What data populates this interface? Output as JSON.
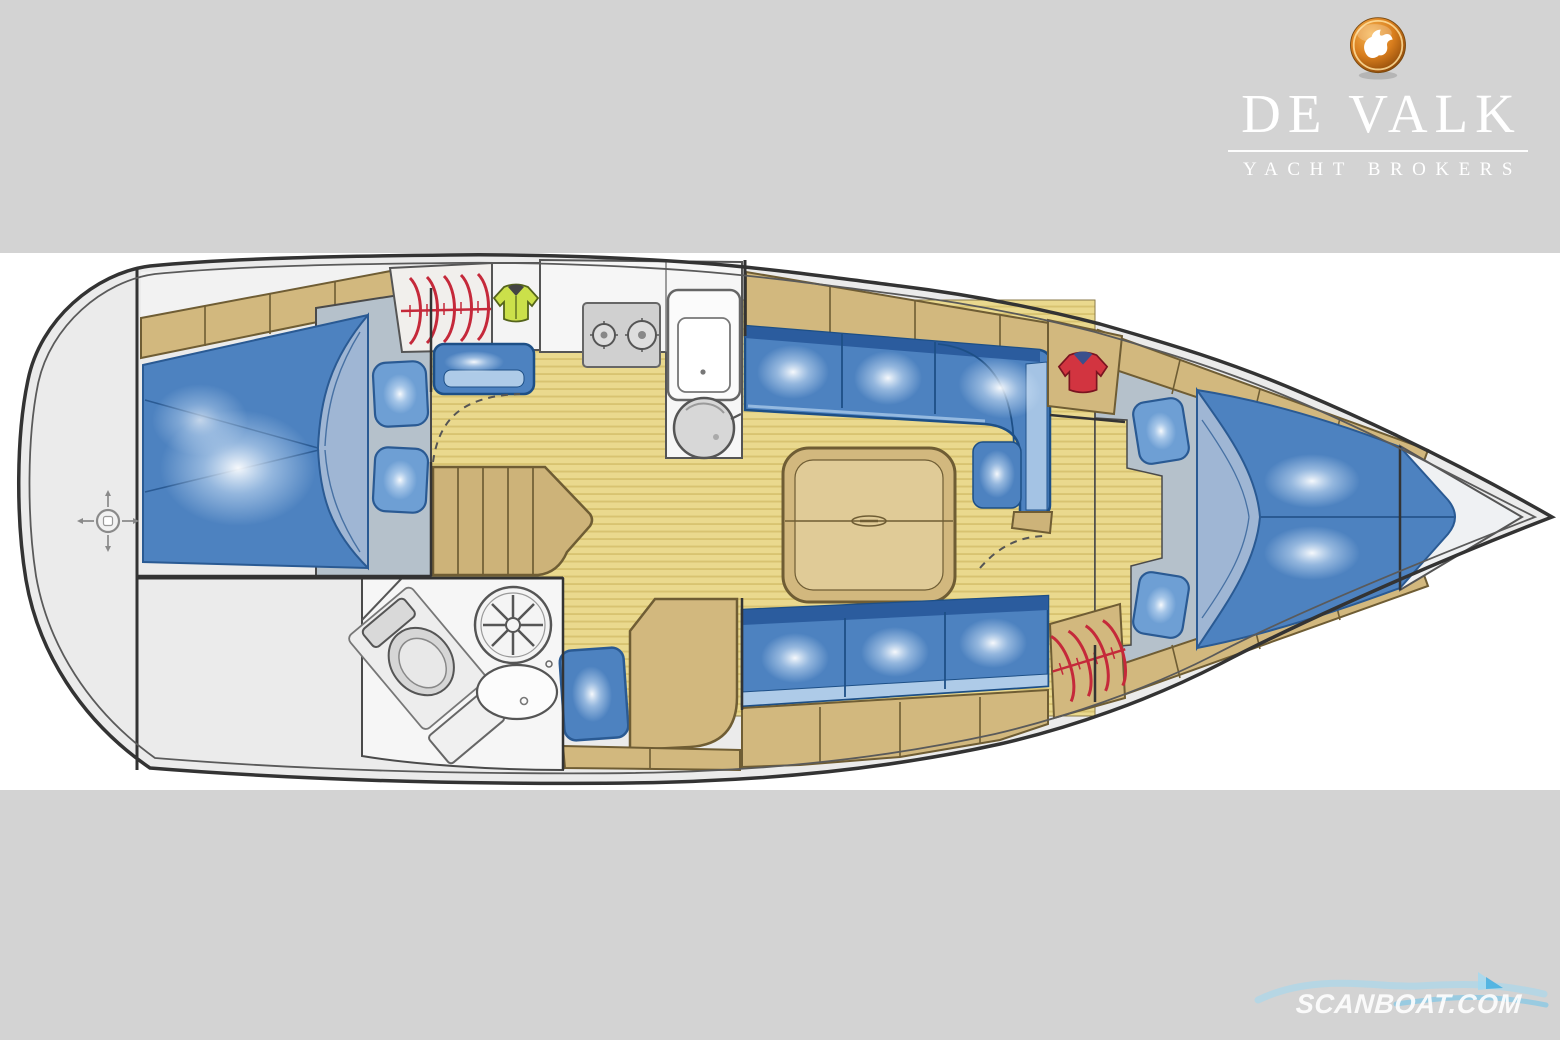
{
  "header": {
    "brand": "DE VALK",
    "tagline": "YACHT BROKERS",
    "logo_icon": "falcon-badge-icon"
  },
  "watermark": {
    "text": "SCANBOAT.COM",
    "icon": "wave-sail-icon"
  },
  "floorplan": {
    "type": "sailing-yacht-interior-layout-top-view",
    "orientation": "bow-right",
    "areas": [
      {
        "name": "stern-deck",
        "icon": "rudder-cross-icon"
      },
      {
        "name": "aft-cabin-double-berth"
      },
      {
        "name": "aft-hanging-locker",
        "icon": "clothes-hangers-icon"
      },
      {
        "name": "wet-locker",
        "icon": "yellow-jacket-icon"
      },
      {
        "name": "companionway-steps"
      },
      {
        "name": "galley",
        "icons": [
          "stove-two-burners-icon",
          "sink-icon",
          "round-basin-icon"
        ]
      },
      {
        "name": "head",
        "icons": [
          "toilet-icon",
          "shower-icon",
          "washbasin-icon"
        ]
      },
      {
        "name": "saloon-l-settee-port"
      },
      {
        "name": "saloon-table"
      },
      {
        "name": "saloon-settee-starboard"
      },
      {
        "name": "nav-seat"
      },
      {
        "name": "chart-table"
      },
      {
        "name": "forward-wardrobe",
        "icon": "red-shirt-icon"
      },
      {
        "name": "forward-hanging-locker",
        "icon": "clothes-hangers-icon"
      },
      {
        "name": "forward-cabin-v-berth"
      },
      {
        "name": "anchor-locker"
      }
    ]
  },
  "colors": {
    "band": "#d3d3d3",
    "plan": "#ffffff",
    "deck": "#ebebeb",
    "hull": "#333333",
    "hullinner": "#5a5a5a",
    "wood": "#d2b87e",
    "woodlight": "#cdb379",
    "woodedge": "#6f5d34",
    "floor": "#ead98e",
    "stripe": "#d5c06c",
    "navy": "#1d4f86",
    "cushion": "#4d82c0",
    "cushionback": "#2b5c9e",
    "cushionfront": "#aecbe8",
    "pillow": "#6e9fd4",
    "pillowedge": "#2a5a93",
    "sheet": "#9fb6d4",
    "mattress": "#b5c1cb",
    "fixture": "#f6f6f6",
    "fixedge": "#555555",
    "steel": "#d4d4d4",
    "red": "#c5293a",
    "shirt": "#d23440",
    "collar": "#3a4f8c",
    "jacket": "#cbe04a",
    "jacketedge": "#55641c",
    "orange1": "#f7b653",
    "orange2": "#d87d1d",
    "orange3": "#8a4708",
    "wmblue": "#9fd9f3",
    "wmblue2": "#5fc3ef"
  }
}
